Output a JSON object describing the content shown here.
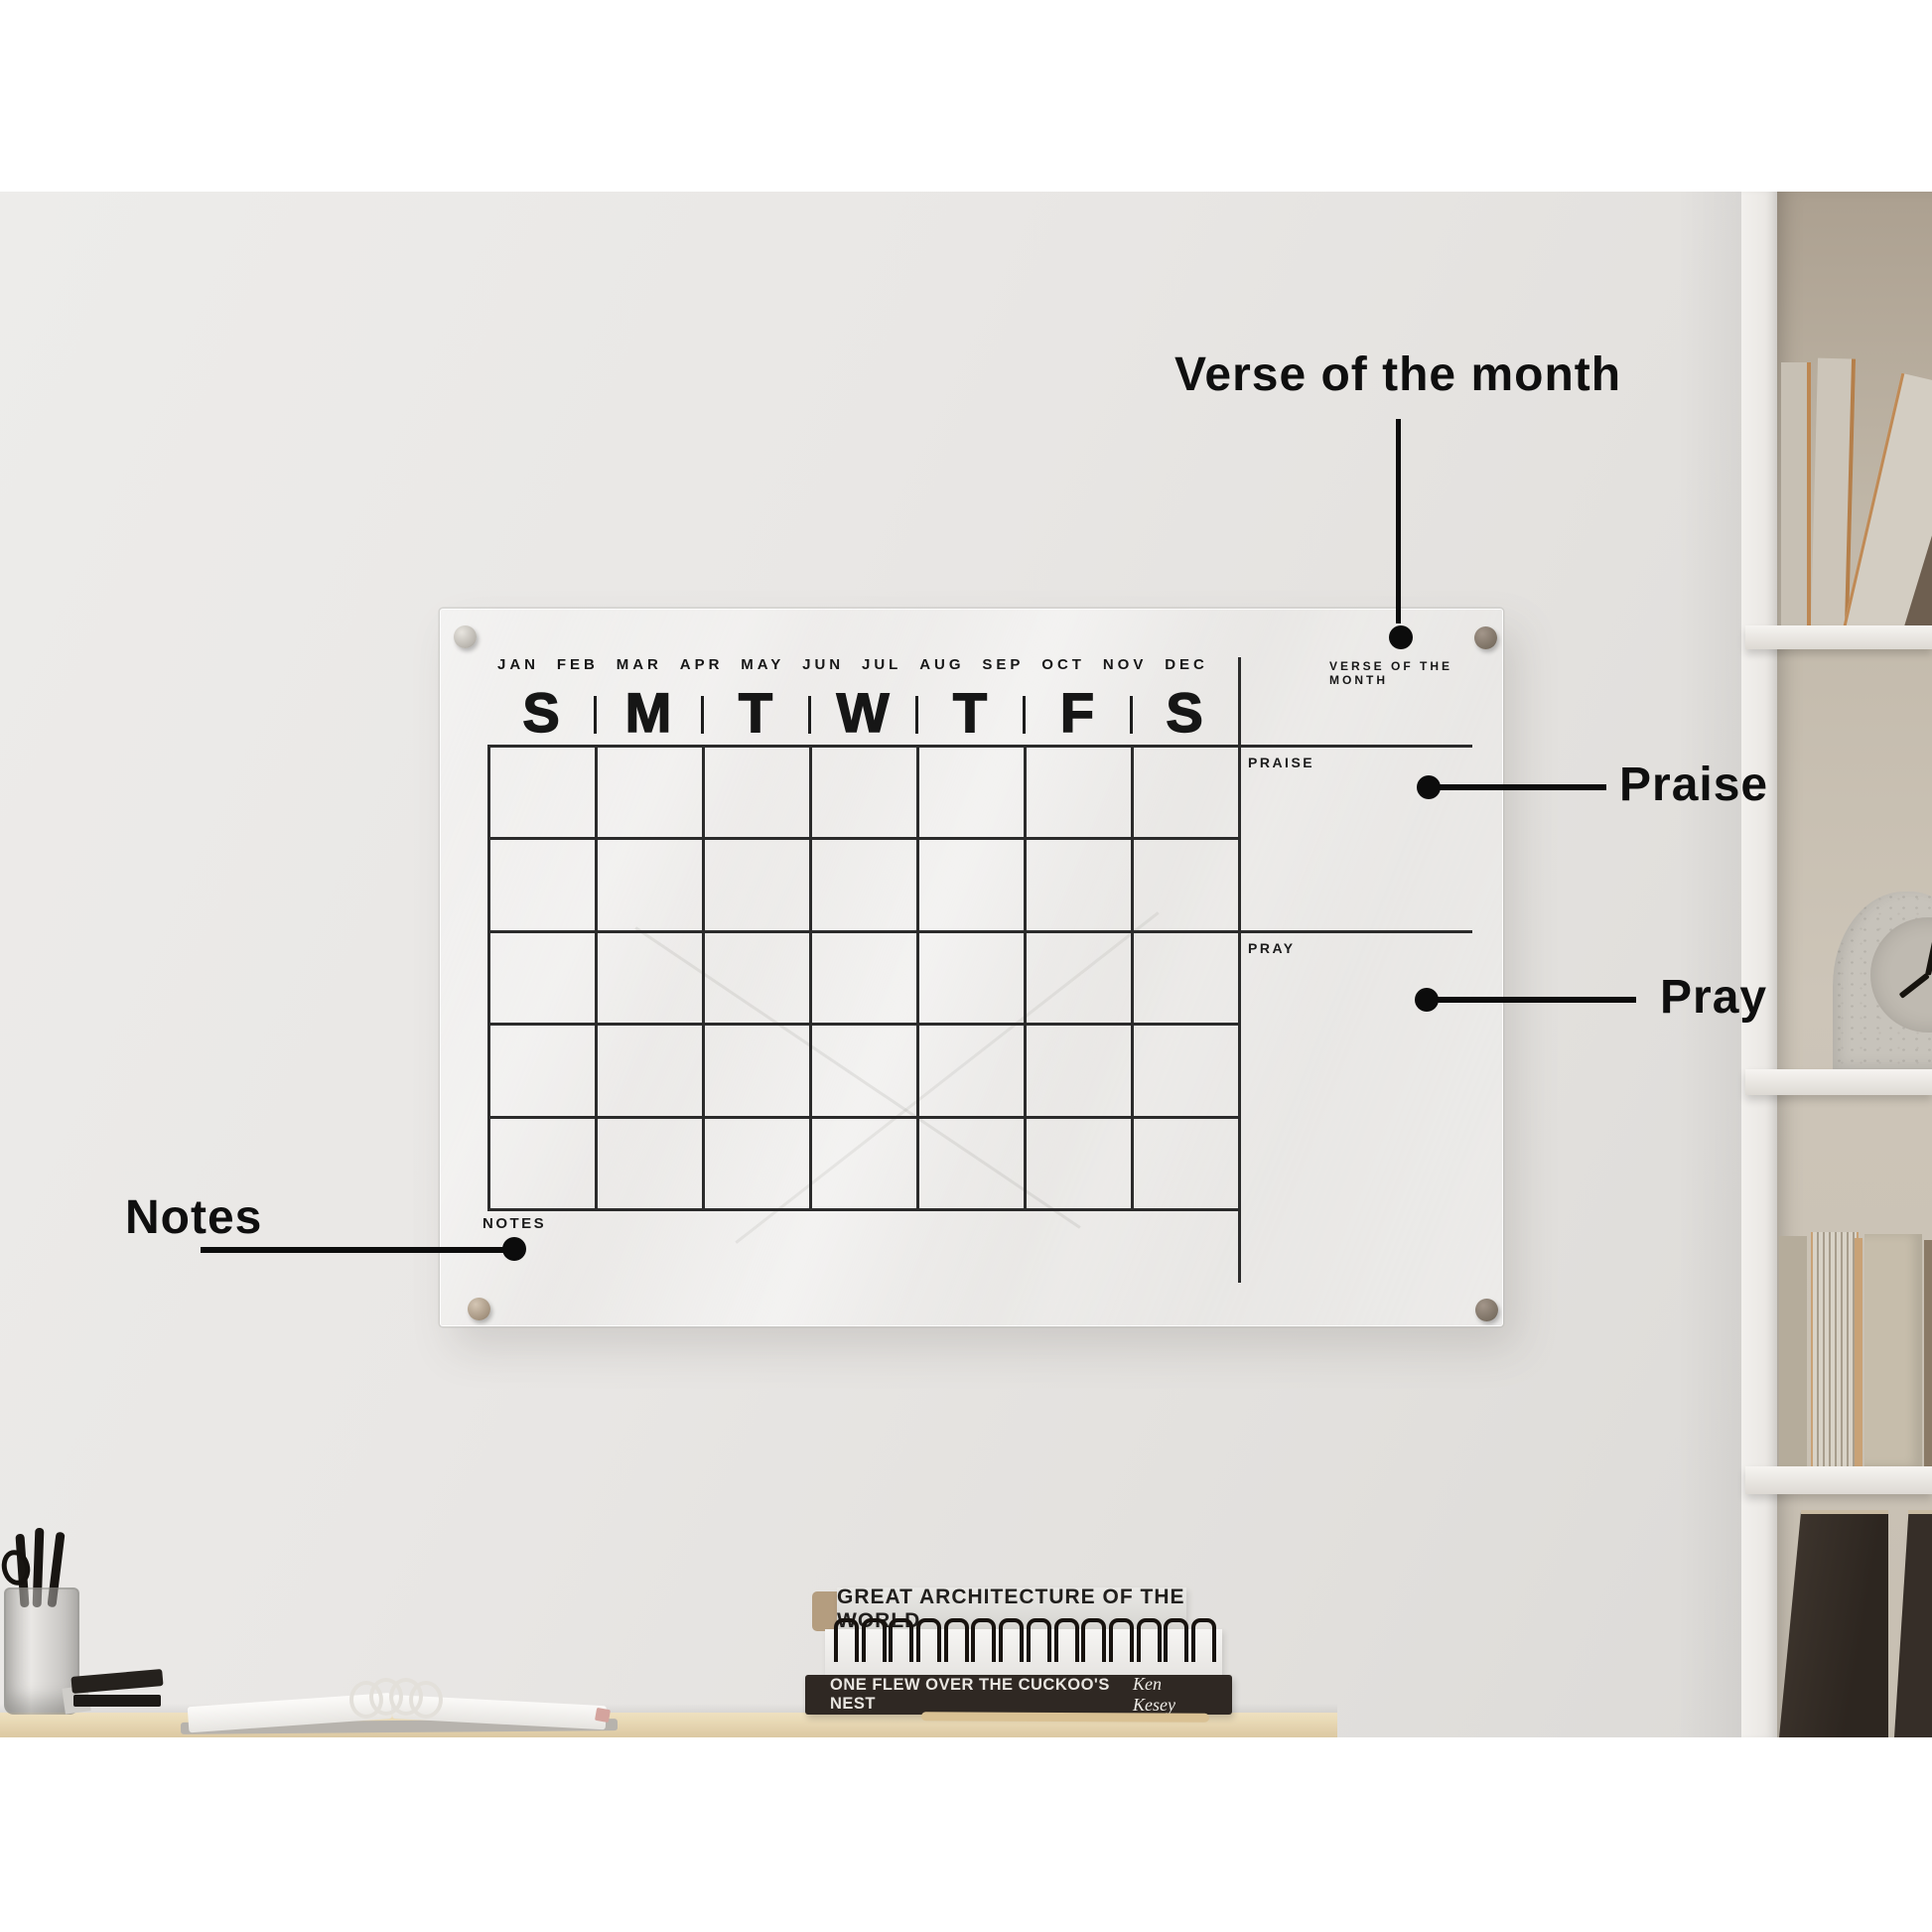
{
  "board": {
    "months": [
      "JAN",
      "FEB",
      "MAR",
      "APR",
      "MAY",
      "JUN",
      "JUL",
      "AUG",
      "SEP",
      "OCT",
      "NOV",
      "DEC"
    ],
    "verse_label": "VERSE OF THE MONTH",
    "days": [
      "S",
      "M",
      "T",
      "W",
      "T",
      "F",
      "S"
    ],
    "praise_label": "PRAISE",
    "pray_label": "PRAY",
    "notes_label": "NOTES"
  },
  "annotations": {
    "verse": "Verse of the month",
    "praise": "Praise",
    "pray": "Pray",
    "notes": "Notes"
  },
  "books": {
    "architecture_title": "GREAT ARCHITECTURE OF THE WORLD",
    "cuckoo_title": "ONE FLEW OVER THE CUCKOO'S NEST",
    "cuckoo_author": "Ken Kesey"
  },
  "colors": {
    "annotation_black": "#0c0c0c",
    "board_line": "#2b2b2b",
    "wall": "#e7e5e2",
    "shelf_beige": "#c7bfb2",
    "desk_wood": "#e6d6b4",
    "dark_book": "#2f2823"
  }
}
